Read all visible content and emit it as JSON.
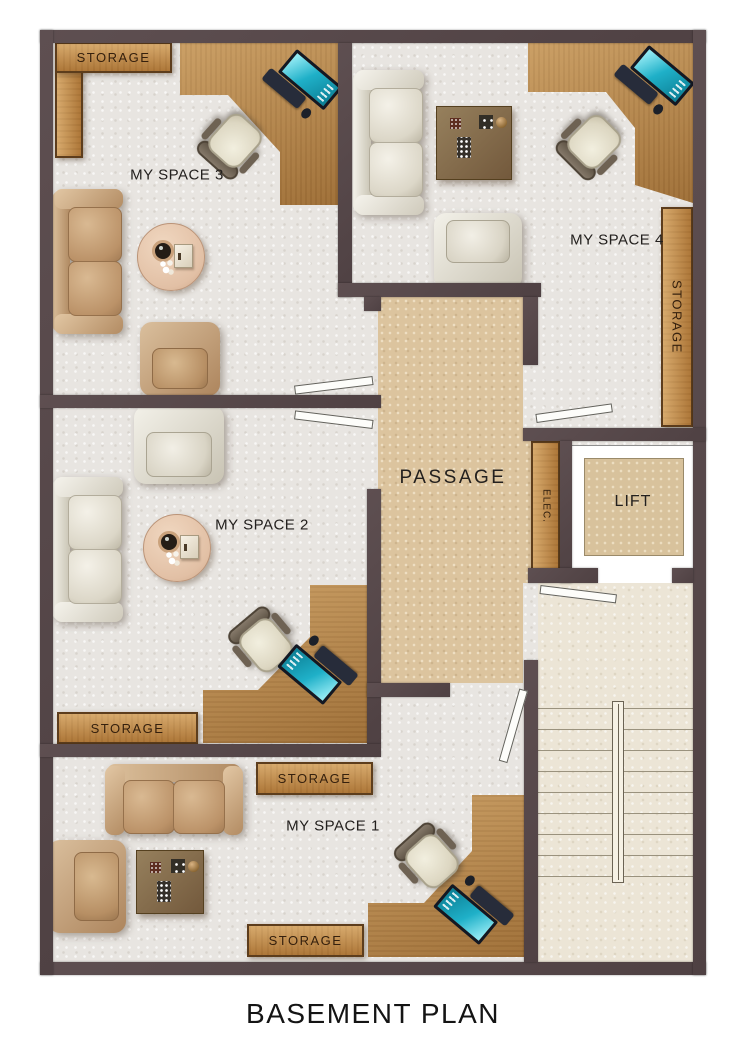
{
  "title": "BASEMENT PLAN",
  "rooms": {
    "space3": "MY SPACE 3",
    "space4": "MY SPACE 4",
    "space2": "MY SPACE 2",
    "space1": "MY SPACE 1",
    "passage": "PASSAGE",
    "lift": "LIFT",
    "elec": "ELEC."
  },
  "storage_units": [
    {
      "id": "storage-top-left",
      "label": "STORAGE"
    },
    {
      "id": "storage-right-vertical",
      "label": "STORAGE"
    },
    {
      "id": "storage-space2",
      "label": "STORAGE"
    },
    {
      "id": "storage-space1-upper",
      "label": "STORAGE"
    },
    {
      "id": "storage-space1-lower",
      "label": "STORAGE"
    }
  ],
  "furniture_icons": {
    "space3": [
      "l-desk",
      "laptop",
      "office-chair",
      "sofa",
      "coffee-table",
      "armchair",
      "storage-cabinet"
    ],
    "space4": [
      "l-desk",
      "laptop",
      "office-chair",
      "sofa",
      "side-table",
      "armchair",
      "storage-cabinet"
    ],
    "space2": [
      "l-desk",
      "laptop",
      "office-chair",
      "sofa",
      "coffee-table",
      "armchair",
      "storage-cabinet"
    ],
    "space1": [
      "l-desk",
      "laptop",
      "office-chair",
      "sofa",
      "side-table",
      "armchair",
      "storage-cabinet"
    ],
    "circulation": [
      "stairs",
      "stair-railing",
      "door-swing"
    ]
  },
  "colors": {
    "wall": "#564749",
    "room_floor": "#e8e5e1",
    "passage_floor": "#dcc49e",
    "stairs_floor": "#ece5d6",
    "lift_floor": "#d8c29c",
    "storage_wood": "#c28a47",
    "desk_wood": "#b58449",
    "laptop_screen": "#1fb0c8",
    "sofa_tan": "#c9a47e",
    "sofa_white": "#e7e4da"
  }
}
